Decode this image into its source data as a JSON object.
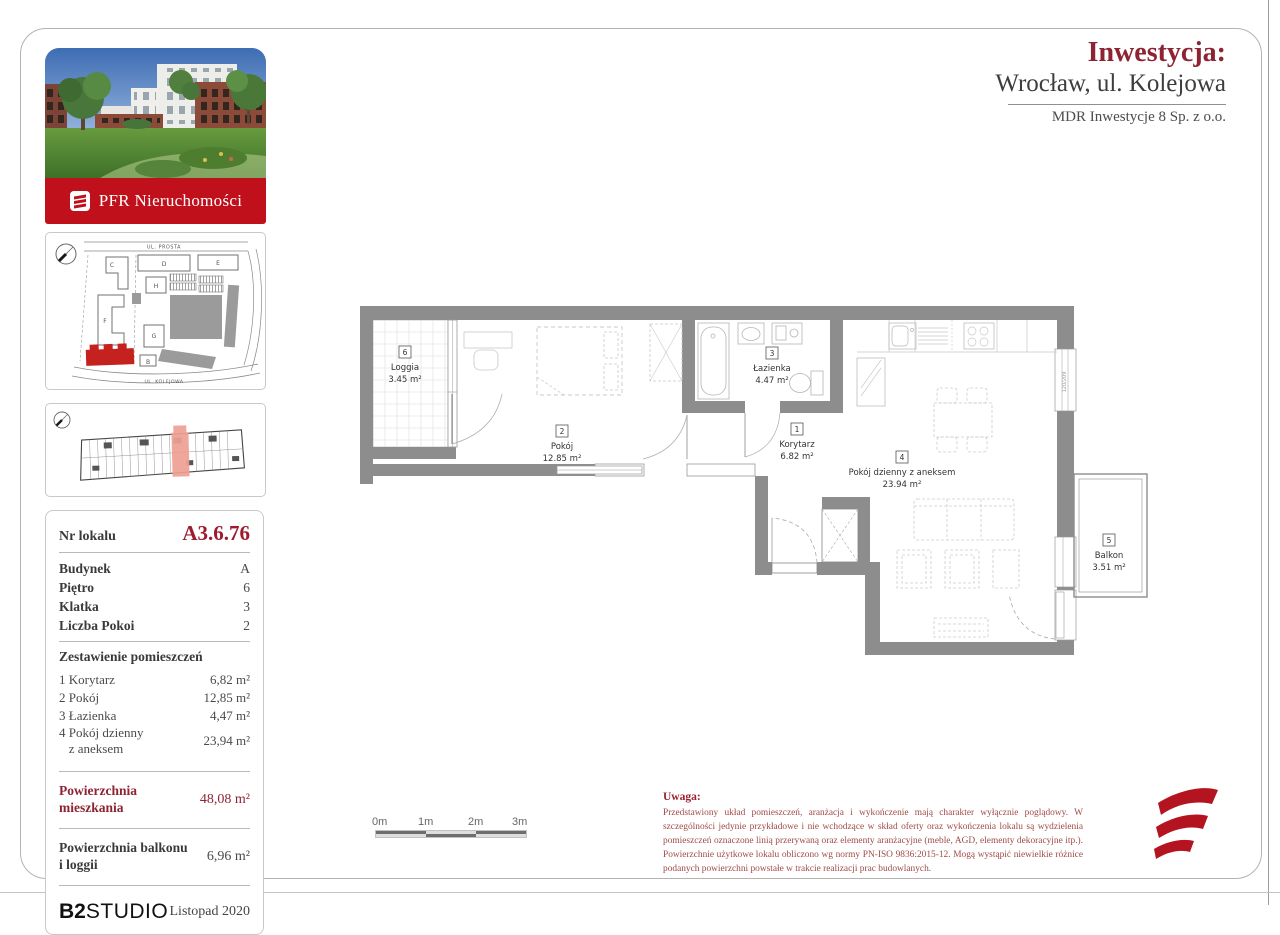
{
  "header": {
    "investment_label": "Inwestycja:",
    "city": "Wrocław, ul. Kolejowa",
    "developer": "MDR Inwestycje 8 Sp. z o.o."
  },
  "branding": {
    "banner": "PFR Nieruchomości",
    "studio_bold": "B2",
    "studio_rest": "STUDIO",
    "issue_date": "Listopad 2020"
  },
  "site_map": {
    "street_top": "UL. PROSTA",
    "street_bottom": "UL. KOLEJOWA",
    "buildings": [
      "C",
      "D",
      "E",
      "H",
      "F",
      "G",
      "B"
    ]
  },
  "unit": {
    "number_label": "Nr lokalu",
    "number": "A3.6.76",
    "fields": [
      {
        "label": "Budynek",
        "value": "A"
      },
      {
        "label": "Piętro",
        "value": "6"
      },
      {
        "label": "Klatka",
        "value": "3"
      },
      {
        "label": "Liczba Pokoi",
        "value": "2"
      }
    ]
  },
  "rooms": {
    "heading": "Zestawienie pomieszczeń",
    "items": [
      {
        "no": "1",
        "name": "Korytarz",
        "area": "6,82 m²"
      },
      {
        "no": "2",
        "name": "Pokój",
        "area": "12,85 m²"
      },
      {
        "no": "3",
        "name": "Łazienka",
        "area": "4,47 m²"
      },
      {
        "no": "4",
        "name_line1": "Pokój dzienny",
        "name_line2": "z aneksem",
        "area": "23,94 m²"
      }
    ]
  },
  "areas": {
    "apartment_label_line1": "Powierzchnia",
    "apartment_label_line2": "mieszkania",
    "apartment_value": "48,08 m²",
    "balcony_label_line1": "Powierzchnia balkonu",
    "balcony_label_line2": "i loggii",
    "balcony_value": "6,96 m²"
  },
  "plan": {
    "rooms": [
      {
        "no": "6",
        "name": "Loggia",
        "area": "3.45 m²"
      },
      {
        "no": "2",
        "name": "Pokój",
        "area": "12.85 m²"
      },
      {
        "no": "3",
        "name": "Łazienka",
        "area": "4.47 m²"
      },
      {
        "no": "1",
        "name": "Korytarz",
        "area": "6.82 m²"
      },
      {
        "no": "4",
        "name": "Pokój dzienny z aneksem",
        "area": "23.94 m²"
      },
      {
        "no": "5",
        "name": "Balkon",
        "area": "3.51 m²"
      }
    ],
    "window_dim": "120/209",
    "scale_labels": [
      "0m",
      "1m",
      "2m",
      "3m"
    ]
  },
  "note": {
    "title": "Uwaga:",
    "body": "Przedstawiony układ pomieszczeń, aranżacja i wykończenie mają charakter wyłącznie poglądowy. W szczególności jedynie przykładowe i nie wchodzące w skład oferty oraz wykończenia lokalu są wydzielenia pomieszczeń oznaczone linią przerywaną oraz elementy aranżacyjne (meble, AGD, elementy dekoracyjne itp.). Powierzchnie użytkowe lokalu obliczono wg normy PN-ISO 9836:2015-12. Mogą wystąpić niewielkie różnice podanych powierzchni powstałe w trakcie realizacji prac budowlanych."
  },
  "colors": {
    "maroon": "#8e2433",
    "banner_red": "#c0101c",
    "unit_number_red": "#9e1b2e",
    "highlight_building_red": "#c4211f",
    "highlight_unit_salmon": "#efa093",
    "wall_gray": "#8d8d8d",
    "note_red": "#a04a45"
  }
}
